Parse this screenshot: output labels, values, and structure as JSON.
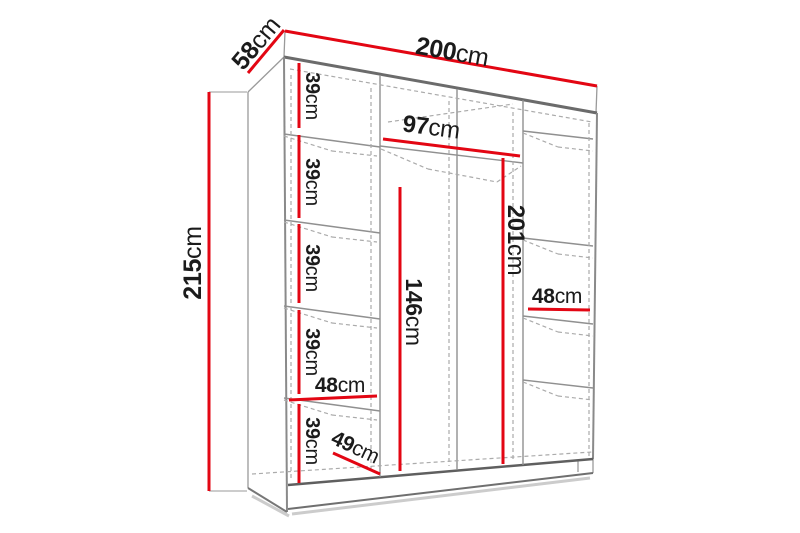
{
  "title": "Wardrobe dimension diagram",
  "colors": {
    "dimension_line": "#e30613",
    "structure_dark": "#666666",
    "structure_light": "#9a9a9a",
    "dashed_line": "#ababab",
    "label_text": "#1b1b1b",
    "background": "#ffffff"
  },
  "dimensions": {
    "width": {
      "value": "200",
      "unit": "cm"
    },
    "depth": {
      "value": "58",
      "unit": "cm"
    },
    "height": {
      "value": "215",
      "unit": "cm"
    },
    "middle_section_width": {
      "value": "97",
      "unit": "cm"
    },
    "interior_height": {
      "value": "201",
      "unit": "cm"
    },
    "hanging_space_height": {
      "value": "146",
      "unit": "cm"
    },
    "left_column_width": {
      "value": "48",
      "unit": "cm"
    },
    "right_column_width": {
      "value": "48",
      "unit": "cm"
    },
    "interior_depth": {
      "value": "49",
      "unit": "cm"
    },
    "shelf_spacings": [
      {
        "value": "39",
        "unit": "cm"
      },
      {
        "value": "39",
        "unit": "cm"
      },
      {
        "value": "39",
        "unit": "cm"
      },
      {
        "value": "39",
        "unit": "cm"
      },
      {
        "value": "39",
        "unit": "cm"
      }
    ]
  }
}
